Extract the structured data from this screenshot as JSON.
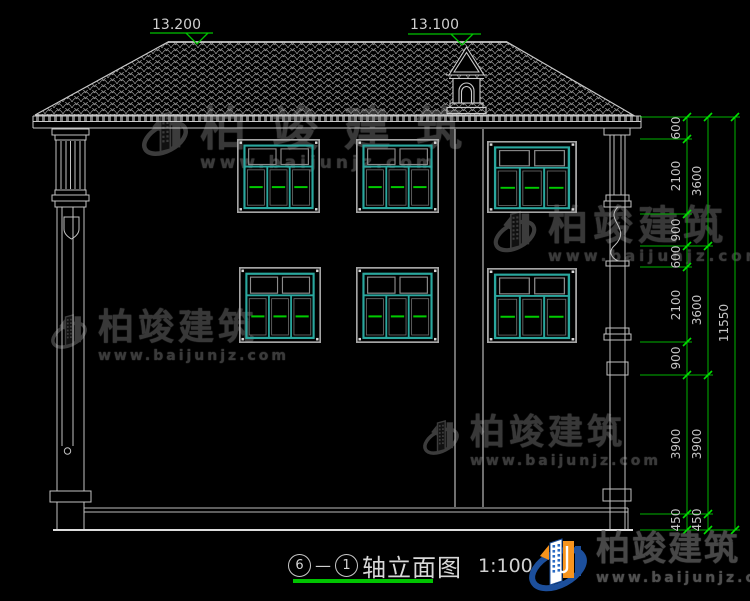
{
  "drawing": {
    "levels": {
      "ridge": "13.200",
      "cupola": "13.100"
    },
    "dimensions": {
      "inner": [
        "600",
        "2100",
        "900",
        "600",
        "2100",
        "900",
        "3900",
        "450"
      ],
      "middle": [
        "3600",
        "3600",
        "3900",
        "450"
      ],
      "overall": "11550"
    }
  },
  "title_block": {
    "axis_from": "6",
    "axis_to": "1",
    "separator": "—",
    "title": "轴立面图",
    "scale": "1:100"
  },
  "watermark": {
    "brand": "柏竣建筑",
    "url": "www.baijunjz.com"
  },
  "footer_logo": {
    "brand": "柏竣建筑",
    "url": "www.baijunjz.com"
  },
  "colors": {
    "background": "#000000",
    "line_white": "#cfcfcf",
    "window_teal": "#2aa79e",
    "annotation_green": "#00c400",
    "watermark_gray": "#3a3a3a",
    "logo_blue": "#1c4f9c",
    "logo_orange": "#f7941d"
  }
}
